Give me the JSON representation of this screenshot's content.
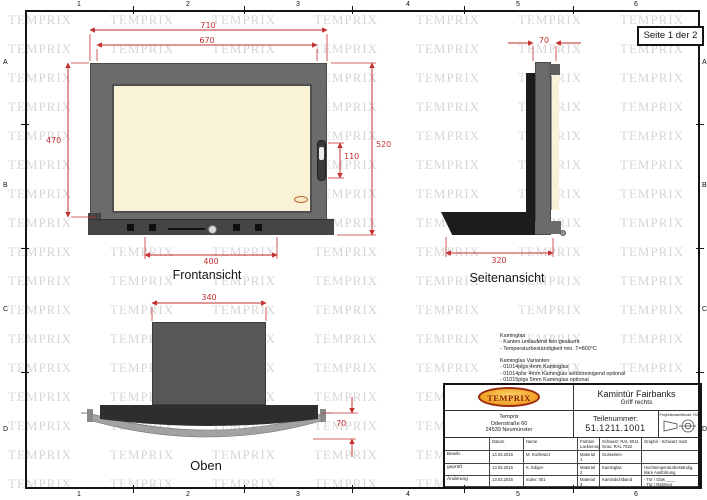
{
  "sheet": {
    "page_label": "Seite 1 der 2"
  },
  "watermark": {
    "text": "TEMPRIX"
  },
  "ruler": {
    "columns": [
      "1",
      "2",
      "3",
      "4",
      "5",
      "6"
    ],
    "rows": [
      "A",
      "B",
      "C",
      "D"
    ]
  },
  "views": {
    "front": {
      "label": "Frontansicht",
      "dims": {
        "outer_width": "710",
        "glass_width": "670",
        "left_height": "470",
        "total_height": "520",
        "handle_height": "110",
        "vent_width": "400"
      }
    },
    "side": {
      "label": "Seitenansicht",
      "dims": {
        "depth_top": "70",
        "depth_bottom": "320"
      }
    },
    "top": {
      "label": "Oben",
      "dims": {
        "width": "340",
        "height": "70"
      }
    }
  },
  "notes": {
    "lines": [
      "Kaminglas",
      "- Kanten umlaufend fein gesäumt",
      "- Temperaturbeständigkeit min. T=800°C",
      "",
      "Kaminglas Varianten:",
      "- 01014plgs 4mm Kaminglas",
      "- 01014plsr 4mm Kaminglas selbstreinigend optional",
      "- 01015plgs 5mm Kaminglas optional"
    ]
  },
  "title_block": {
    "logo_text": "TEMPRIX",
    "title": "Kamintür Fairbanks",
    "subtitle": "Griff rechts",
    "company": "Temprix\nOdenstraße 60\n24539 Neumünster",
    "part_number_label": "Teilenummer:",
    "part_number": "51.1211.1001",
    "projection_label": "Projektionsmethode: ISO",
    "table": {
      "header": {
        "c0": "",
        "datum": "Datum",
        "name": "Name",
        "c3": "Farbton\nLackierung",
        "c4": "Schwarz: RAL 9011\nGrau: RAL 7022",
        "c5": "Graphit - Schwarz matt"
      },
      "rows": [
        {
          "label": "Bearb.",
          "datum": "13.03.2016",
          "name": "M. Kozlewicz",
          "c3": "Material 1",
          "c4": "Gusseisen",
          "c5": ""
        },
        {
          "label": "geprüft",
          "datum": "13.03.2016",
          "name": "K. Ediger",
          "c3": "Material 2",
          "c4": "Kaminglas",
          "c5": "Hochtemperaturbeständig,\nklare Ausführung"
        },
        {
          "label": "Änderung",
          "datum": "13.03.2016",
          "name": "Index: 001",
          "c3": "Material 3",
          "c4": "Kamindichtband",
          "c5": "- Tür / Glas ____\n- Tür / Rahmen ____"
        }
      ]
    }
  },
  "colors": {
    "dimension_red": "#c62f2f",
    "frame_gray": "#6b6b6b",
    "glass_cream": "#f8f2d6",
    "dark_steel": "#1c1c1c",
    "logo_orange": "#f0a125",
    "logo_red": "#8c2208",
    "watermark_gray": "#e3dfdf"
  }
}
